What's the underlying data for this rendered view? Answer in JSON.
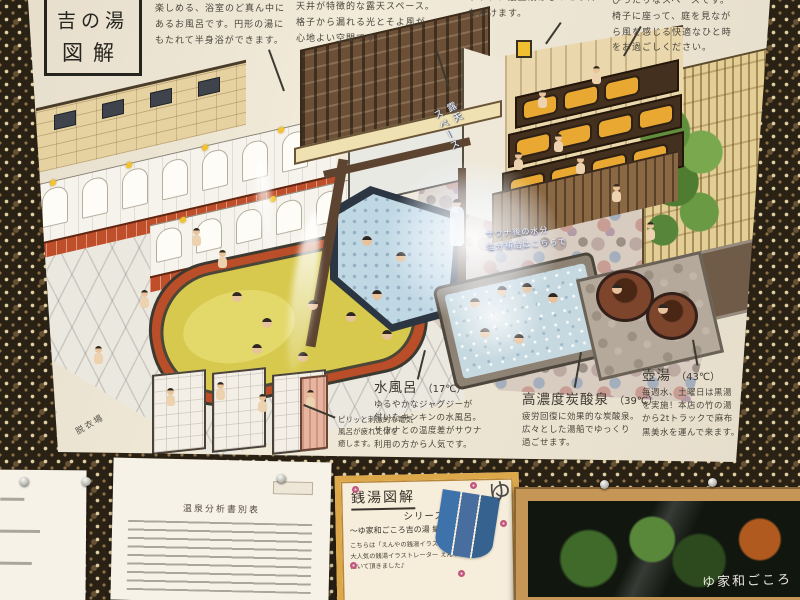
{
  "scene": "Photo of an illustrated sento (bathhouse) floor-guide poster pinned to a patterned wall, with documents and a framed sign below",
  "colors": {
    "wall_dark": "#2a2115",
    "wall_motif": "#e8d8aa",
    "poster_bg": "#ece4d2",
    "bath_yellow": "#d7c94d",
    "bath_cold_blue": "#c0d8e3",
    "bath_carbo_blue": "#c6d9e0",
    "ledge_red": "#bf4e2a",
    "sauna_mat_orange": "#e8a832",
    "card_border_gold": "#dca849",
    "noren_blue": "#3e72aa",
    "frame_wood": "#c59655"
  },
  "poster": {
    "title": {
      "line1": "吉の湯",
      "line2": "図解"
    },
    "notes": {
      "center_bath": "楽しめる、浴室のど真ん中に\nあるお風呂です。円形の湯に\nもたれて半身浴ができます。",
      "roofed_space": "天井が特徴的な露天スペース。\n格子から漏れる光とそよ風が\n心地よい空間です。",
      "sauna_top": "サウナ、最上段はじっとり汗\nをかけます。",
      "chairs_space": "ぴったりなスペースです。\n椅子に座って、庭を見なが\nら風を感じる快適なひと時\nをお過ごしください。",
      "electric_bath": "ピリッと刺激的な電気\n風呂が疲れた体を\n癒します。",
      "floor_sign": "露天\nスペース",
      "drink_sign": "サウナ後の水分\n塩分補給はこちらで",
      "dressing_room": "脱衣場",
      "credit": "Illust by enyahoneya"
    },
    "baths": [
      {
        "name": "水風呂",
        "temp": "（17℃）",
        "desc": "ゆるやかなジャグジーが\n付いたキンキンの水風呂。\nサウナとの温度差がサウナ\n利用の方から人気です。"
      },
      {
        "name": "高濃度炭酸泉",
        "temp": "（39℃）",
        "desc": "疲労回復に効果的な炭酸泉。\n広々とした湯船でゆっくり\n過ごせます。"
      },
      {
        "name": "壺湯",
        "temp": "（43℃）",
        "desc": "毎週水、土曜日は黒湯\nを実施！本店の竹の湯\nから2tトラックで麻布\n黒美水を運んで来ます。"
      }
    ]
  },
  "wall_items": {
    "analysis_doc": {
      "title": "温泉分析書別表"
    },
    "note_card": {
      "title": "銭湯図解",
      "series": "シリーズ",
      "edition": "〜ゆ家和ごころ吉の湯 編〜",
      "body": "こちらは「えんやの銭湯イラストめぐり」で\n大人気の銭湯イラストレーター えんや氏に\n描いて頂きました♪",
      "noren_char": "ゆ"
    },
    "framed_sign": {
      "text": "ゆ家和ごころ"
    }
  }
}
